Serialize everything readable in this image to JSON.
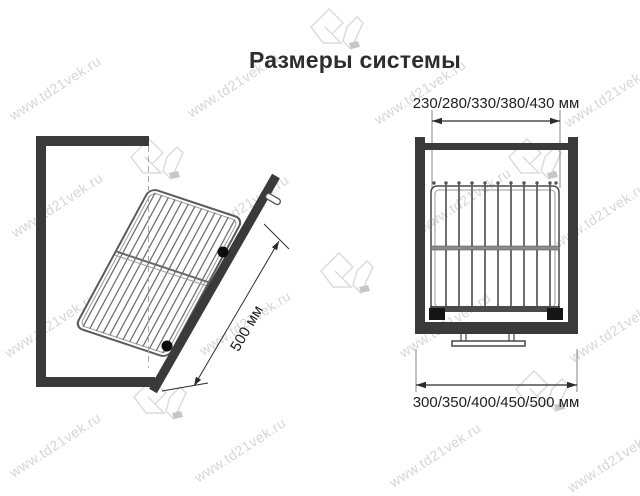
{
  "page": {
    "title": "Размеры системы"
  },
  "watermark": {
    "text": "www.td21vek.ru"
  },
  "left_diagram": {
    "dimension_depth": "500 мм"
  },
  "right_diagram": {
    "dimension_width_top": "230/280/330/380/430 мм",
    "dimension_width_bottom": "300/350/400/450/500 мм"
  },
  "colors": {
    "frame": "#3a3a3a",
    "wire": "#707070",
    "dim": "#2b2b2b",
    "text": "#1f1f1f",
    "wm": "#d6d6d6",
    "bg": "#ffffff"
  }
}
